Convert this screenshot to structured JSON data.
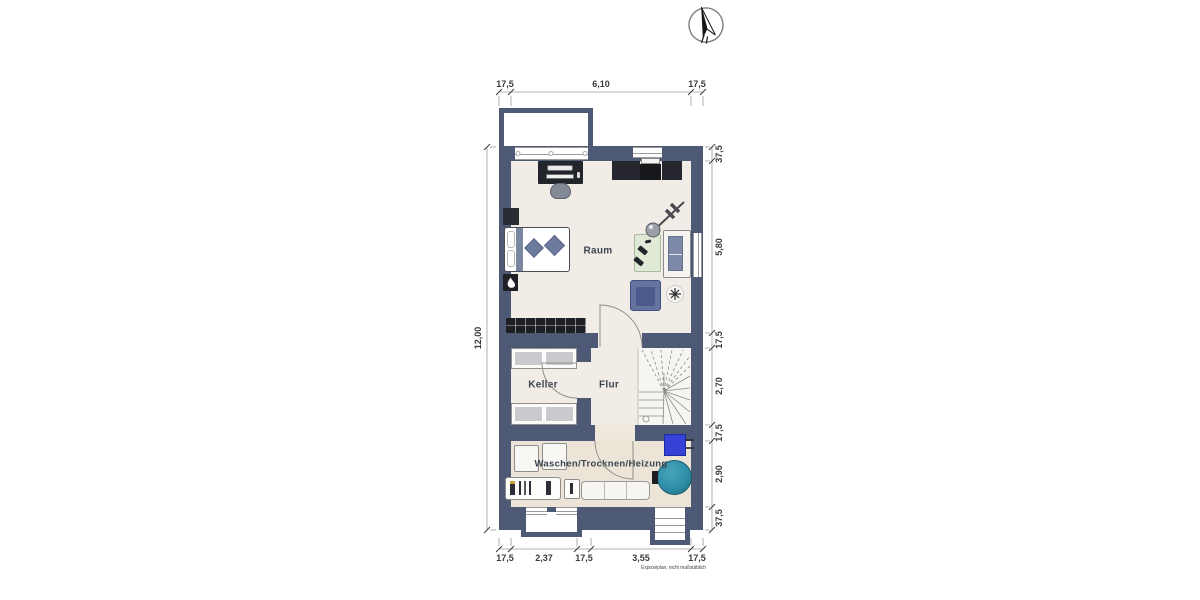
{
  "plan": {
    "rooms": {
      "raum": "Raum",
      "keller": "Keller",
      "flur": "Flur",
      "waschen": "Waschen/Trocknen/Heizung"
    },
    "dims": {
      "top": [
        "17,5",
        "6,10",
        "17,5"
      ],
      "right": [
        "37,5",
        "5,80",
        "17,5",
        "2,70",
        "17,5",
        "2,90",
        "37,5"
      ],
      "left": [
        "12,00"
      ],
      "bottom": [
        "17,5",
        "2,37",
        "17,5",
        "3,55",
        "17,5"
      ]
    },
    "footnote": "Exposéplan, nicht maßstäblich",
    "icons": {
      "compass": "north-arrow"
    },
    "colors": {
      "wall": "#4e5975",
      "floor": "#f1ede6",
      "laundry_floor": "#ebe4d7",
      "heater_blue": "#3641d8",
      "boiler_teal": "#2f8fa8",
      "armchair_blue": "#64749f",
      "mat_green": "#e0e9d6"
    }
  }
}
